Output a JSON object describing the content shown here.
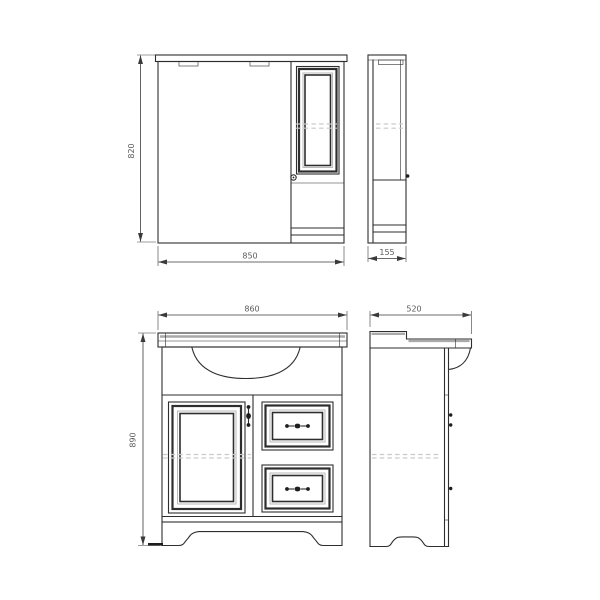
{
  "drawing": {
    "colors": {
      "line": "#2e2e2e",
      "shading_gray": "#a9a9a9",
      "dashed_hidden_line": "#c9c9c9",
      "dimension_text": "#5a5a5a",
      "background": "#ffffff"
    },
    "mirror_cabinet": {
      "front": {
        "height_label": "820",
        "width_label": "850"
      },
      "side": {
        "depth_label": "155"
      }
    },
    "vanity": {
      "front": {
        "width_label": "860",
        "height_label": "890"
      },
      "side": {
        "depth_label": "520"
      }
    }
  }
}
